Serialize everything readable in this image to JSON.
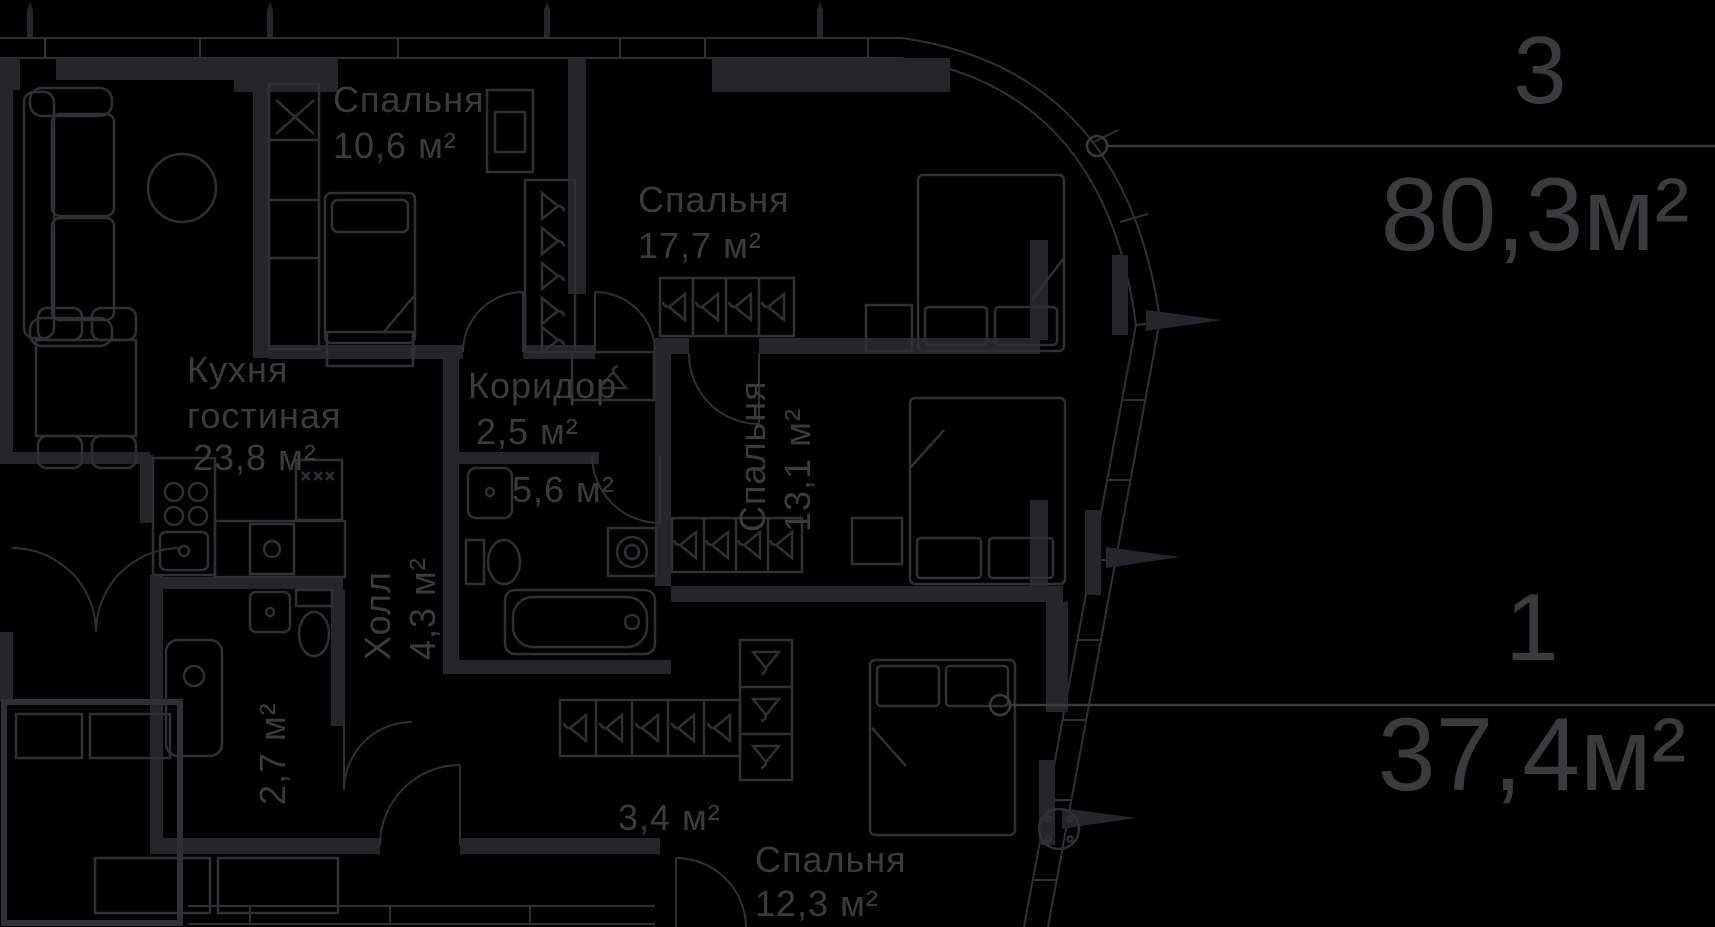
{
  "colors": {
    "background": "#000000",
    "walls": "#26262a",
    "lines": "#303034",
    "text": "#3b3b3e"
  },
  "rooms": [
    {
      "label": "Спальня",
      "area": "10,6 м²"
    },
    {
      "label": "Спальня",
      "area": "17,7 м²"
    },
    {
      "label": "Кухня",
      "label2": "гостиная",
      "area": "23,8 м²"
    },
    {
      "label": "Коридор",
      "area": "2,5 м²"
    },
    {
      "area": "5,6 м²"
    },
    {
      "label": "Спальня",
      "area": "13,1 м²"
    },
    {
      "label": "Холл",
      "area": "4,3 м²"
    },
    {
      "area": "2,7 м²"
    },
    {
      "area": "3,4 м²"
    },
    {
      "label": "Спальня",
      "area": "12,3 м²"
    }
  ],
  "apartments": [
    {
      "number": "3",
      "area": "80,3м²"
    },
    {
      "number": "1",
      "area": "37,4м²"
    }
  ]
}
